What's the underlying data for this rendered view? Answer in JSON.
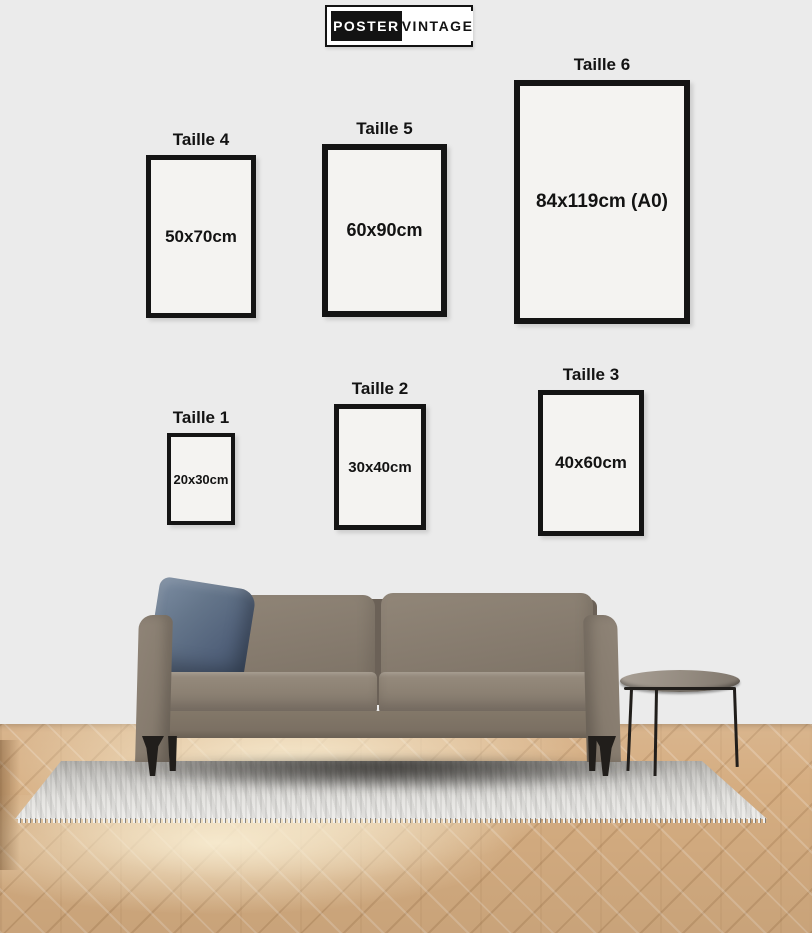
{
  "brand": {
    "name_left": "POSTER",
    "name_right": "VINTAGE"
  },
  "size_guide": {
    "sizes": [
      {
        "label": "Taille 1",
        "dimensions": "20x30cm"
      },
      {
        "label": "Taille 2",
        "dimensions": "30x40cm"
      },
      {
        "label": "Taille 3",
        "dimensions": "40x60cm"
      },
      {
        "label": "Taille 4",
        "dimensions": "50x70cm"
      },
      {
        "label": "Taille 5",
        "dimensions": "60x90cm"
      },
      {
        "label": "Taille 6",
        "dimensions": "84x119cm (A0)"
      }
    ]
  },
  "scene": {
    "objects": [
      "sofa",
      "throw-pillow",
      "area-rug",
      "side-table",
      "herringbone-wood-floor"
    ]
  },
  "palette": {
    "wall": "#ebebeb",
    "ink": "#131313",
    "frame-border": "#141414",
    "frame-fill": "#f4f3f1",
    "logo-bg": "#ffffff",
    "floor-mid": "#d5ad81",
    "sunlight": "#faf0d6",
    "rug-light": "#eeedeb",
    "rug-dark": "#b5b3af",
    "sofa-body": "#867b6e",
    "sofa-dark": "#6b6157",
    "pillow-blue": "#5c6d80",
    "table-top": "#948b80",
    "metal-dark": "#211e1b"
  }
}
